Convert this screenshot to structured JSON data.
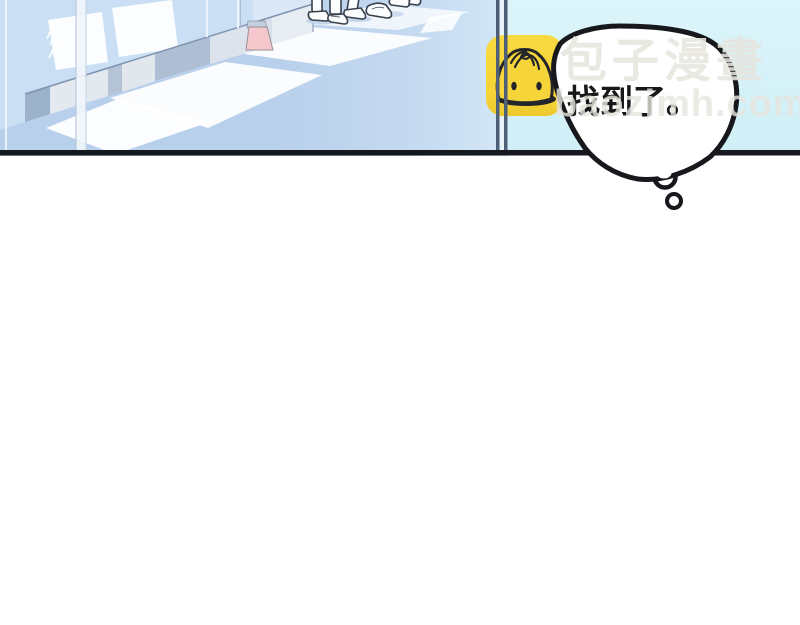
{
  "comic": {
    "speech_bubble": {
      "text": "找到了。"
    }
  },
  "watermark": {
    "logo_icon": "baozi-bun-icon",
    "site_name": "包子漫畫",
    "site_url": "baozimh.com"
  },
  "colors": {
    "wall_blue": "#cbdff4",
    "floor_blue": "#b9d0ec",
    "glass_cyan": "#d8f3f9",
    "logo_yellow": "#f6d53a",
    "sign_pink": "#f4c8cd",
    "panel_border": "#15181d",
    "bubble_outline": "#16181c",
    "watermark_text": "#e7e5de"
  }
}
